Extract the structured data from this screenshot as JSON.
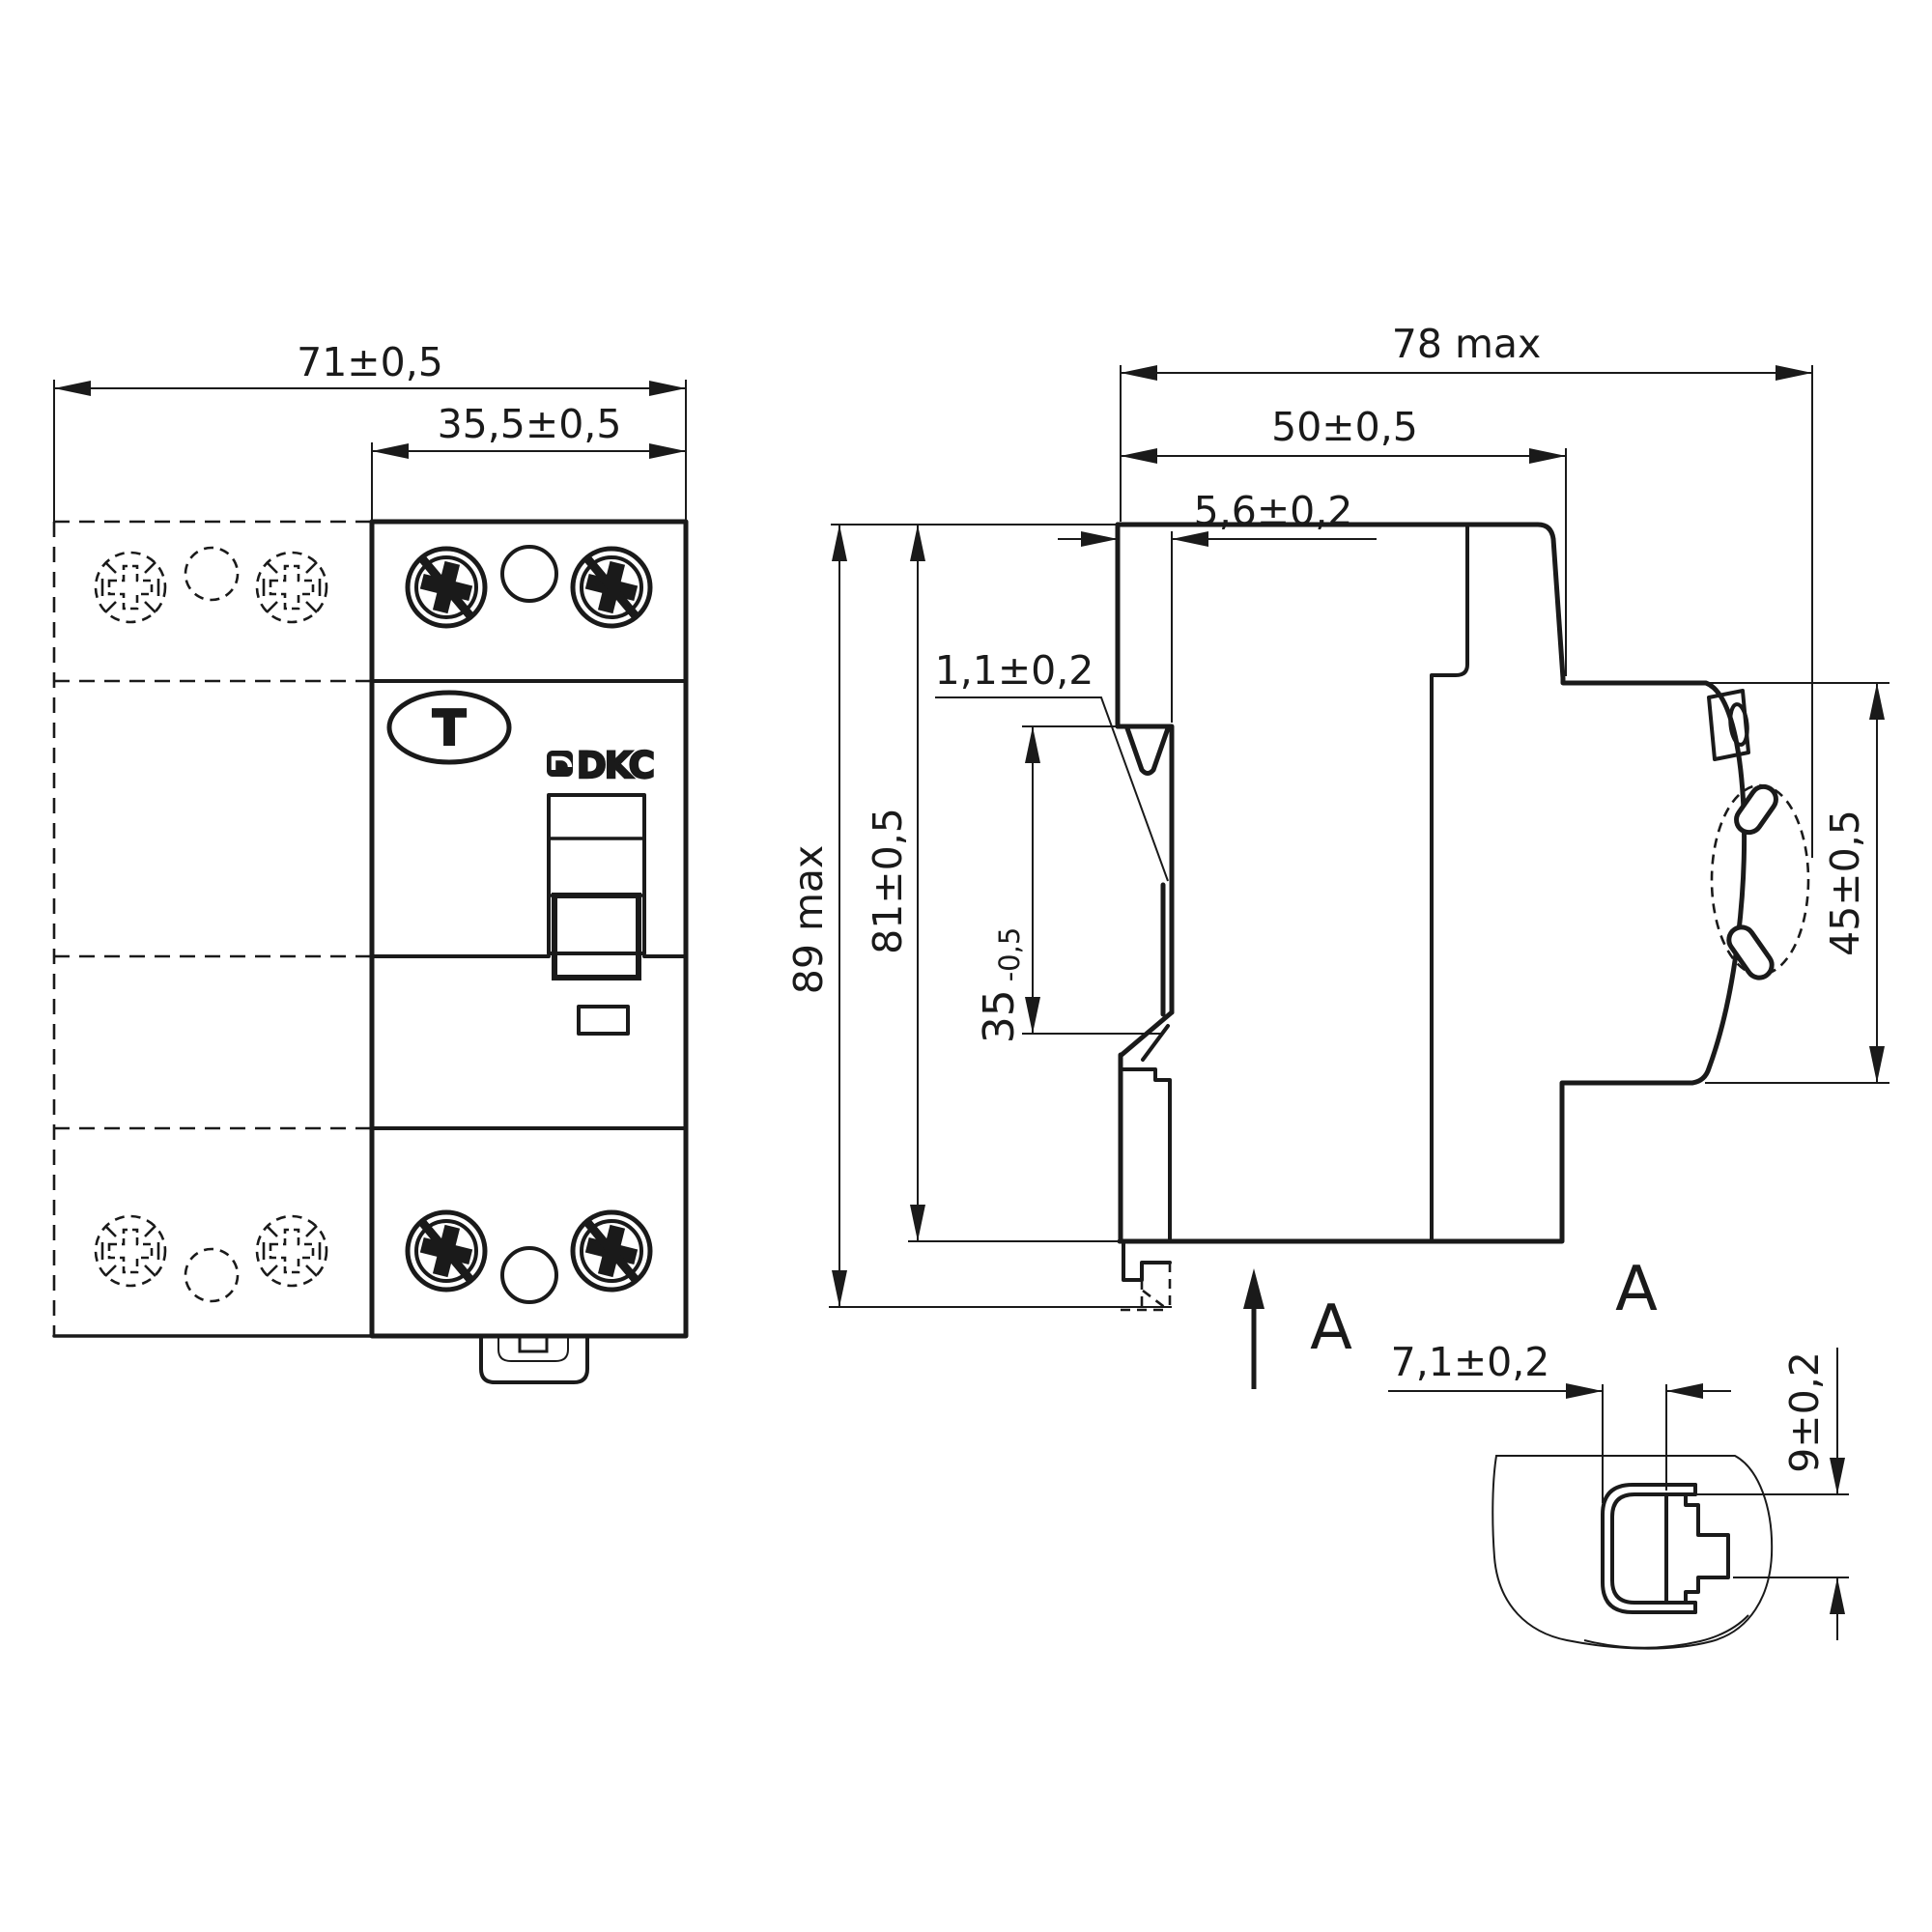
{
  "front_view": {
    "dim_total_width": "71±0,5",
    "dim_module_width": "35,5±0,5",
    "test_button_label": "T",
    "brand_logo": "DKC"
  },
  "side_view": {
    "dim_depth_max": "78 max",
    "dim_depth_body": "50±0,5",
    "dim_din_offset": "5,6±0,2",
    "dim_din_step": "1,1±0,2",
    "dim_height_max": "89 max",
    "dim_height_body": "81±0,5",
    "dim_din_rail_value": "35",
    "dim_din_rail_tolerance": "-0,5",
    "dim_front_height": "45±0,5",
    "section_arrow_label": "A"
  },
  "detail_view": {
    "view_label": "A",
    "dim_clip_width": "7,1±0,2",
    "dim_clip_height": "9±0,2"
  },
  "colors": {
    "line": "#1a1a1a",
    "background": "#ffffff"
  }
}
